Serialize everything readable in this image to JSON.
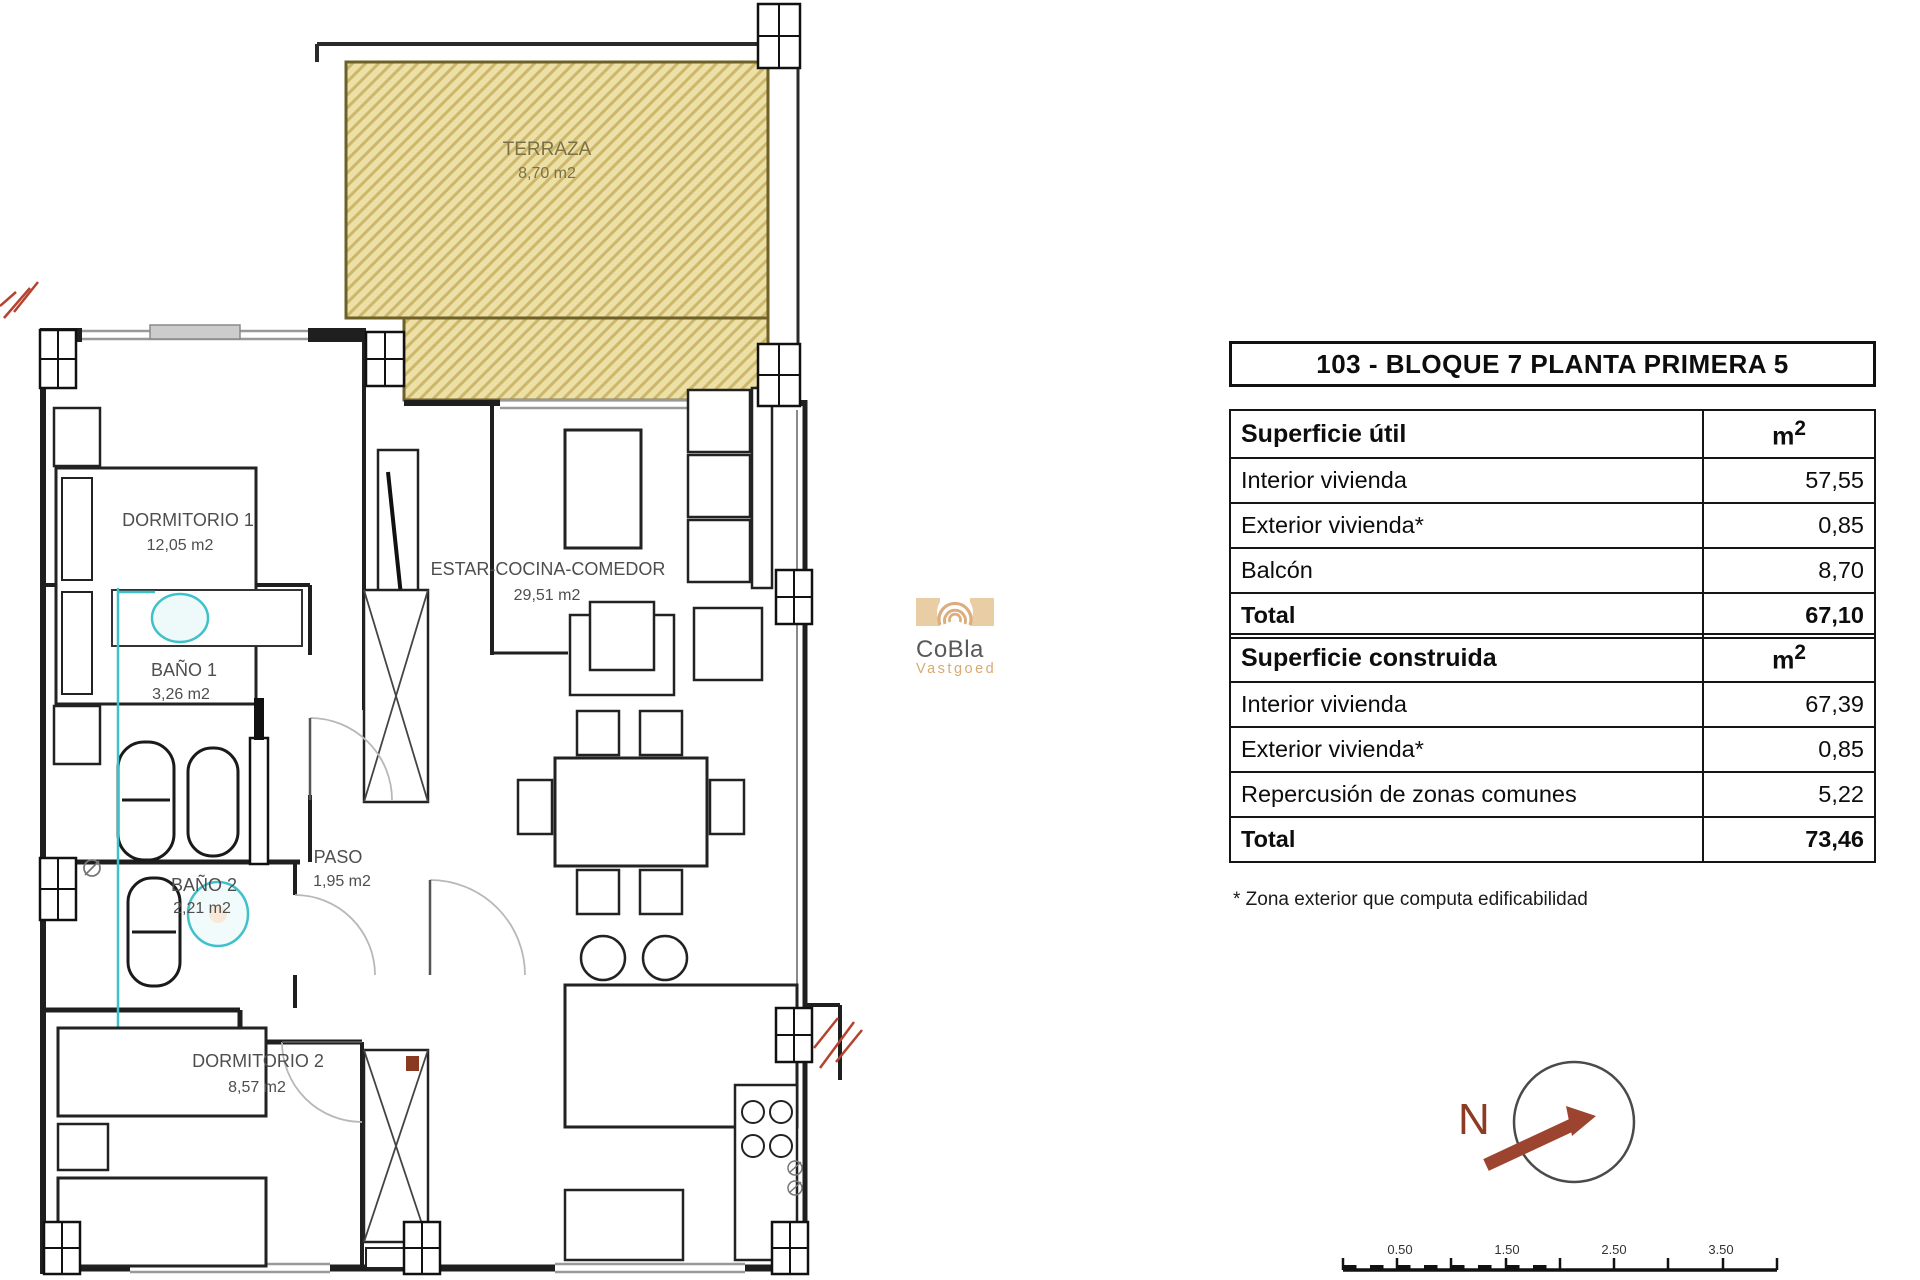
{
  "panel": {
    "title": "103 - BLOQUE 7 PLANTA PRIMERA 5",
    "unit_m": "m",
    "unit_exp": "2",
    "superficie_util": {
      "header": "Superficie útil",
      "rows": [
        {
          "label": "Interior vivienda",
          "value": "57,55"
        },
        {
          "label": "Exterior vivienda*",
          "value": "0,85"
        },
        {
          "label": "Balcón",
          "value": "8,70"
        },
        {
          "label": "Total",
          "value": "67,10"
        }
      ]
    },
    "superficie_construida": {
      "header": "Superficie construida",
      "rows": [
        {
          "label": "Interior vivienda",
          "value": "67,39"
        },
        {
          "label": "Exterior vivienda*",
          "value": "0,85"
        },
        {
          "label": "Repercusión de zonas comunes",
          "value": "5,22"
        },
        {
          "label": "Total",
          "value": "73,46"
        }
      ]
    },
    "footnote": "* Zona exterior que computa edificabilidad"
  },
  "floorplan": {
    "rooms": [
      {
        "name": "TERRAZA",
        "area": "8,70 m2"
      },
      {
        "name": "DORMITORIO 1",
        "area": "12,05 m2"
      },
      {
        "name": "BAÑO 1",
        "area": "3,26 m2"
      },
      {
        "name": "BAÑO 2",
        "area": "2,21 m2"
      },
      {
        "name": "PASO",
        "area": "1,95 m2"
      },
      {
        "name": "ESTAR-COCINA-COMEDOR",
        "area": "29,51 m2"
      },
      {
        "name": "DORMITORIO 2",
        "area": "8,57 m2"
      }
    ]
  },
  "logo": {
    "name": "CoBla",
    "subtitle": "Vastgoed"
  },
  "compass": {
    "north_label": "N"
  },
  "scale_bar": {
    "labels": [
      "0.50",
      "1.50",
      "2.50",
      "3.50"
    ]
  },
  "colors": {
    "terraza_fill": "#ece0a6",
    "terraza_hatch": "#cdb76a",
    "terraza_border": "#6d6128",
    "plumbing_cyan": "#3fc1c9",
    "break_red": "#b5432f",
    "compass_red": "#9c4430",
    "logo_tan": "#dcae7e",
    "logo_gray": "#58595b"
  }
}
